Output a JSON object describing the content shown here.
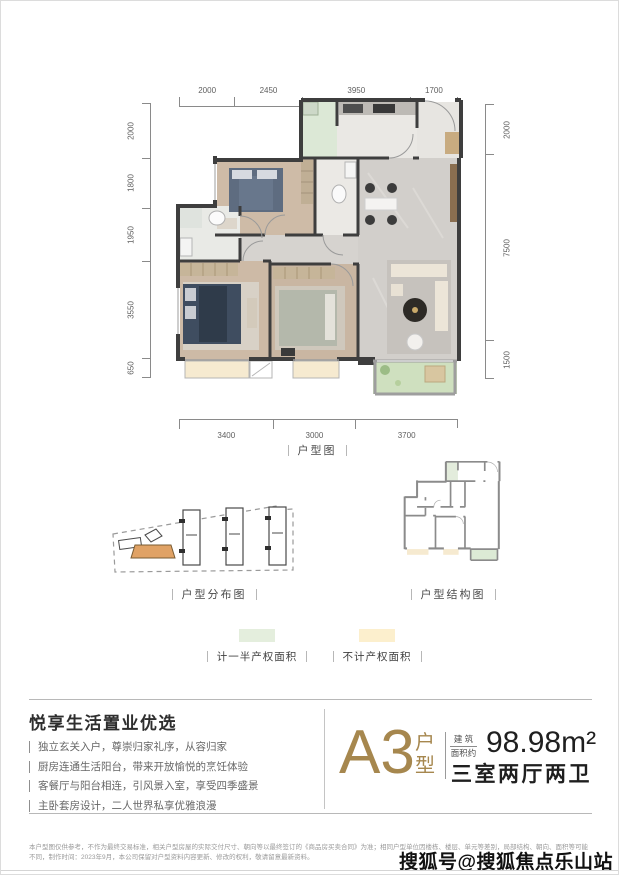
{
  "plan": {
    "caption": "户型图",
    "dims": {
      "top": [
        "2000",
        "2450",
        "3950",
        "1700"
      ],
      "left": [
        "2000",
        "1800",
        "1950",
        "3550",
        "650"
      ],
      "right": [
        "2000",
        "7500",
        "1500"
      ],
      "bottom": [
        "3400",
        "3000",
        "3700"
      ]
    }
  },
  "diagrams": {
    "distribution_caption": "户型分布图",
    "structure_caption": "户型结构图"
  },
  "legend": {
    "half": {
      "label": "计一半产权面积",
      "color": "#e4eedd"
    },
    "none": {
      "label": "不计产权面积",
      "color": "#fcefcd"
    }
  },
  "info": {
    "title": "悦享生活置业优选",
    "bullets": [
      "独立玄关入户，尊崇归家礼序，从容归家",
      "厨房连通生活阳台，带来开放愉悦的烹饪体验",
      "客餐厅与阳台相连，引风景入室，享受四季盛景",
      "主卧套房设计，二人世界私享优雅浪漫"
    ],
    "unit_name": "A3",
    "unit_suffix": [
      "户",
      "型"
    ],
    "area_label_1": "建 筑",
    "area_label_2": "面积约",
    "area_value": "98.98m²",
    "rooms": "三室两厅两卫"
  },
  "footer": {
    "disclaimer": "本户型图仅供参考，不作为最终交易标准，相关户型房屋的实际交付尺寸、朝向等以最终签订的《商品房买卖合同》为准；相同户型单位因楼栋、楼层、单元等差别，局部结构、朝向、面积等可能不同，制作时间：2023年9月，本公司保留对户型资料内容更新、修改的权利，敬请留意最新资料。",
    "watermark": "搜狐号@搜狐焦点乐山站"
  },
  "colors": {
    "accent_bronze": "#a6874e",
    "wall": "#3e3e3e",
    "legend_half_green": "#e4eedd",
    "legend_none_yellow": "#fcefcd",
    "highlight_unit_orange": "#e0a265"
  }
}
